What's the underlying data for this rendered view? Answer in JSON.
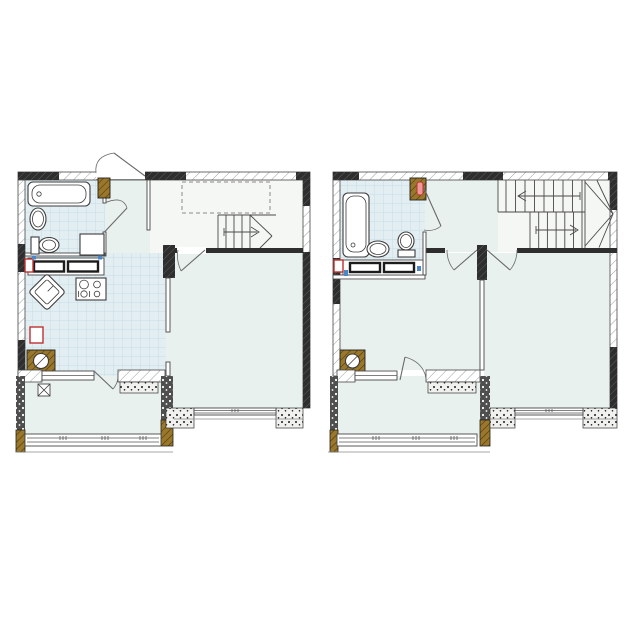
{
  "image": {
    "type": "architectural-floor-plan-pair",
    "description": "Two-level duplex apartment floor plans side by side, no text labels",
    "background": "#ffffff"
  },
  "palette": {
    "white": "#ffffff",
    "wall": "#2e2e2e",
    "wall_hl": "#6a6a6a",
    "line": "#474747",
    "hatch": "#9aa0a0",
    "room": "#e8f1ee",
    "tile": "#e2eef2",
    "tile_line": "#c6dde5",
    "stair": "#f5f7f4",
    "balcony_wall": "#4f4f4f",
    "flank": "#f1f1ef",
    "dot": "#1c1c1c",
    "wood": "#9a772b",
    "wood_line": "#4d3a0c",
    "red": "#c03131",
    "pink": "#ef9a9a",
    "blue": "#4d86c8",
    "arc": "#6a6a6a",
    "dash": "#8a8a8a"
  },
  "plans": [
    {
      "id": "level-1",
      "position": "left",
      "rooms": [
        "bathroom",
        "entry-hall",
        "kitchen",
        "stair-hall",
        "living-room",
        "balcony"
      ],
      "fixtures": [
        "bathtub",
        "washbasin",
        "toilet",
        "washing-machine",
        "kitchen-counter",
        "cooktop",
        "corner-sink",
        "vent-shaft",
        "gas-riser",
        "entrance-door",
        "bathroom-door",
        "living-room-door",
        "balcony-door",
        "stairs-up-arrow",
        "stair-void-dashed",
        "balcony-window",
        "living-room-window"
      ]
    },
    {
      "id": "level-2",
      "position": "right",
      "rooms": [
        "bathroom",
        "hall",
        "bedroom-left",
        "bedroom-right",
        "stair-well",
        "balcony"
      ],
      "fixtures": [
        "bathtub",
        "washbasin",
        "toilet",
        "vanity-counter",
        "boiler-riser",
        "vent-shaft",
        "bathroom-door",
        "bedroom-left-door",
        "bedroom-right-door",
        "balcony-door",
        "u-turn-stairs-arrows",
        "balcony-window",
        "bedroom-window"
      ]
    }
  ]
}
